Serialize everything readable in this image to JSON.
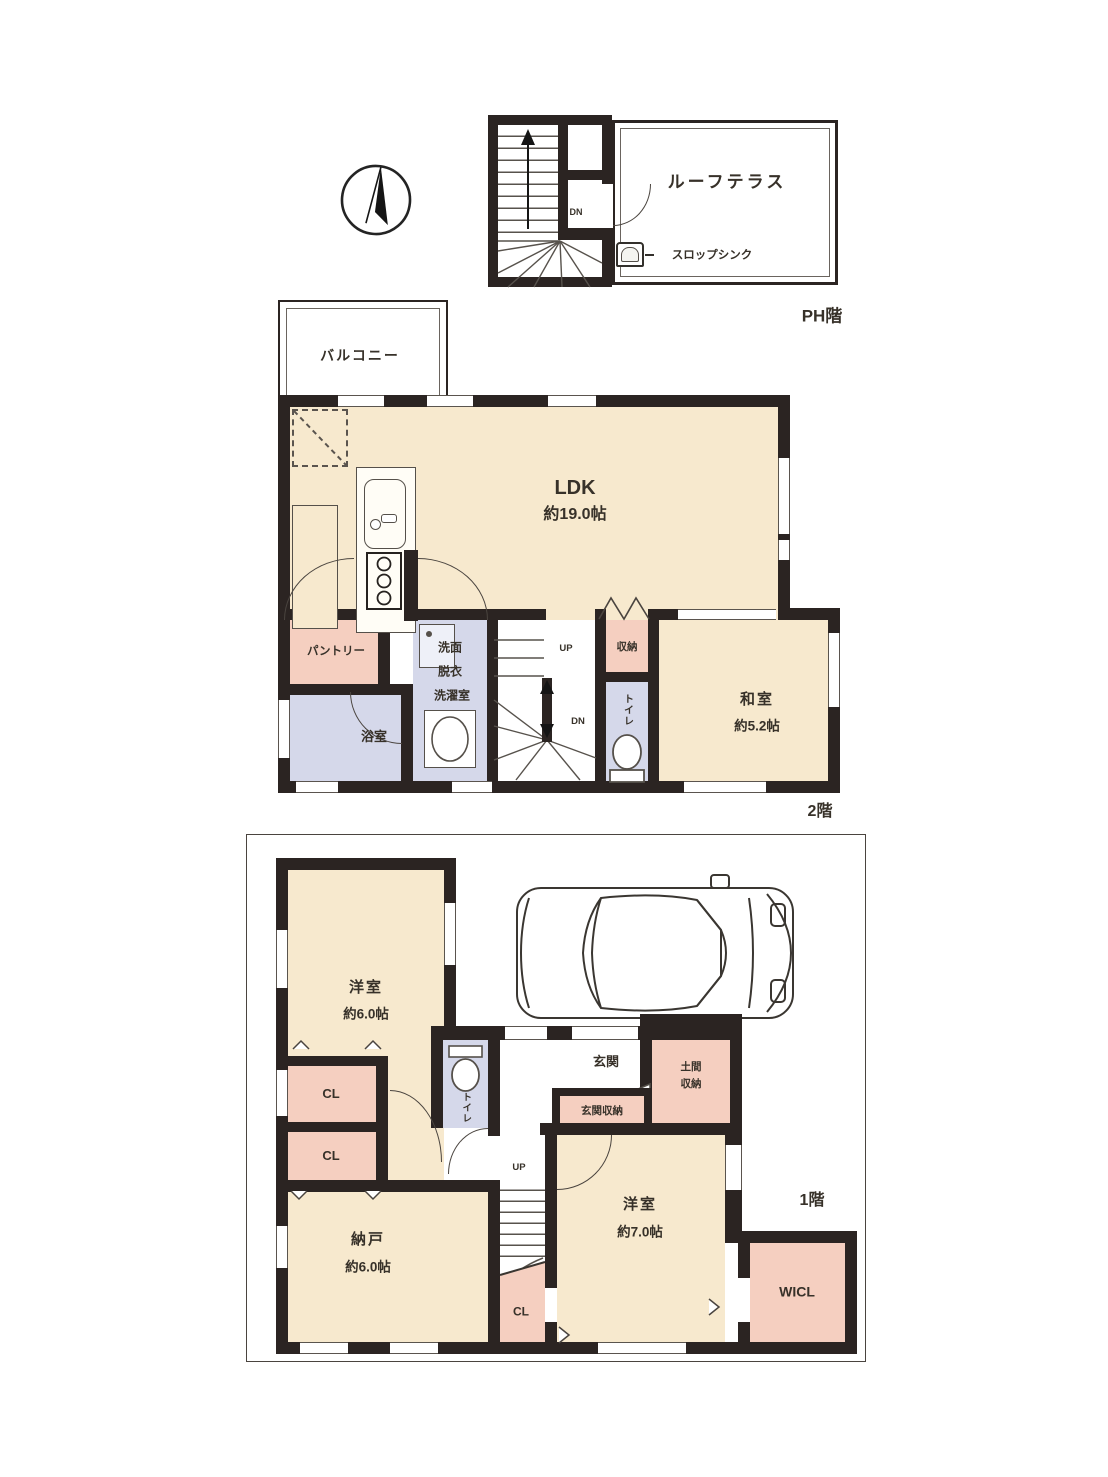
{
  "document": {
    "type": "japanese-floor-plan"
  },
  "colors": {
    "wall": "#2b2422",
    "room_cream": "#f7e9ce",
    "room_pink": "#f5cfc0",
    "room_lavender": "#d5d8ea",
    "line": "#4a443f"
  },
  "ph": {
    "floor_label": "PH階",
    "terrace_label": "ルーフテラス",
    "sink_label": "スロップシンク",
    "down_label": "DN"
  },
  "f2": {
    "floor_label": "2階",
    "balcony_label": "バルコニー",
    "ldk_label": "LDK",
    "ldk_size": "約19.0帖",
    "pantry_label": "パントリー",
    "bath_label": "浴室",
    "wash_line1": "洗面",
    "wash_line2": "脱衣",
    "wash_line3": "洗濯室",
    "up_label": "UP",
    "down_label": "DN",
    "storage_label": "収納",
    "toilet_label": "トイレ",
    "washitsu_label": "和室",
    "washitsu_size": "約5.2帖"
  },
  "f1": {
    "floor_label": "1階",
    "western6_label": "洋室",
    "western6_size": "約6.0帖",
    "toilet_label": "トイレ",
    "entrance_label": "玄関",
    "doma_line1": "土間",
    "doma_line2": "収納",
    "entrance_storage_label": "玄関収納",
    "closet_label": "CL",
    "nando_label": "納戸",
    "nando_size": "約6.0帖",
    "western7_label": "洋室",
    "western7_size": "約7.0帖",
    "wicl_label": "WICL",
    "up_label": "UP"
  }
}
